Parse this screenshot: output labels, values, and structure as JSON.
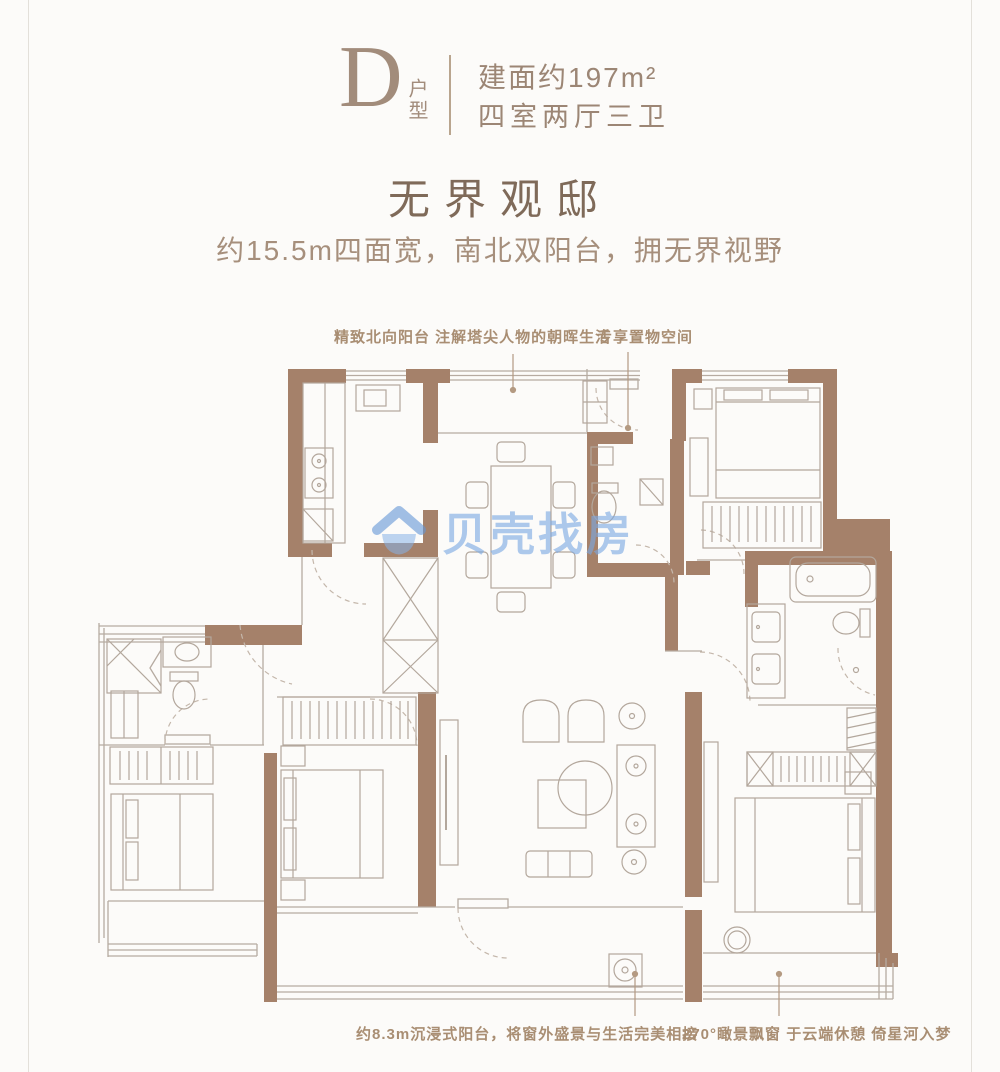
{
  "header": {
    "unit_letter": "D",
    "unit_label": "户型",
    "area": "建面约197m²",
    "rooms": "四室两厅三卫"
  },
  "hero": {
    "title": "无界观邸",
    "subtitle": "约15.5m四面宽，南北双阳台，拥无界视野"
  },
  "callouts": {
    "north_balcony": "精致北向阳台 注解塔尖人物的朝晖生活",
    "storage": "专享置物空间",
    "south_balcony": "约8.3m沉浸式阳台，将窗外盛景与生活完美相接",
    "bay_window": "270°瞰景飘窗 于云端休憩 倚星河入梦"
  },
  "watermark": {
    "text": "贝壳找房"
  },
  "colors": {
    "wall": "#a5816a",
    "thin_line": "#b6aba1",
    "furniture_line": "#b3a79c",
    "door_arc": "#c4b7ab",
    "leader": "#b49a82",
    "header_text": "#9c8675",
    "title_text": "#7f6a59",
    "watermark_blue": "#7aa8e2",
    "background": "#fcfbf9"
  }
}
